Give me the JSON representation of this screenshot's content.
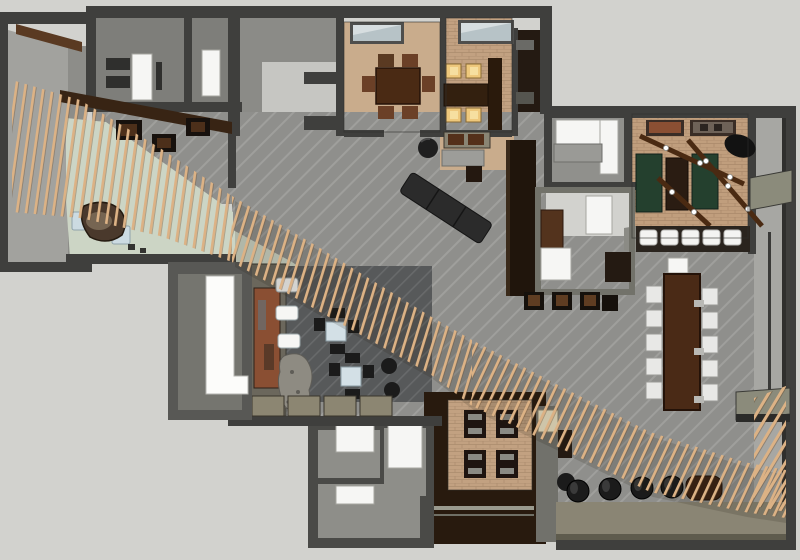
{
  "meta": {
    "kind": "3d-floorplan-render",
    "view": "top-down cutaway of an interior (restaurant / lounge) model",
    "canvas": "800x560"
  },
  "palette": {
    "bg": "#d2d2ce",
    "wall": "#3f3f3d",
    "wall_mid": "#6e6e67",
    "roof": "#a2a29e",
    "carpet": "#8f8f8c",
    "carpet_light": "#c6c6c2",
    "tan": "#c9ac8c",
    "brick": "#c2a181",
    "green_floor": "#ccd5c5",
    "lounge_floor": "#57595a",
    "wood_dark": "#281a0e",
    "wood_mid": "#5a3a22",
    "slat": "#dcb285",
    "seat_white": "#f6f6f4",
    "glow": "#eec87c",
    "table_green": "#24402e",
    "black": "#1b1b1b",
    "olive": "#8a8574",
    "skylight": "#b7c3c7",
    "art_rust": "#8a4f33"
  },
  "areas": {
    "entry_lobby": "entry lobby with curved reception desk",
    "left_rooms": "twin rooms with white beds",
    "top_room": "empty gray room",
    "dining_a": "private dining room with six-seat wood table",
    "dining_b": "private dining room with four lit seats",
    "kitchen": "dark service / kitchen block",
    "sofa_room": "lounge room with white sectional sofa",
    "games_room": "games room with green tables and beam lights",
    "communal": "long communal table with ten white chairs",
    "office": "small study room with desk and daybed",
    "art_lounge": "dark lounge with cafe tables, art wall, benches and boulder",
    "restroom": "room with white L-shaped lit counter",
    "back_rooms": "bottom service rooms",
    "private_booth": "booth dining room over stair well",
    "bar_edge": "bottom-right rail with round stools",
    "slat_screen": "curved timber slat ribbon sweeping across the plan"
  },
  "counts": {
    "communal_chairs": 10,
    "glow_seats": 4,
    "games_cushions": 5,
    "round_stools": 5,
    "white_benches": 3,
    "booth_tables": 4,
    "slat_band_segments": 4
  }
}
